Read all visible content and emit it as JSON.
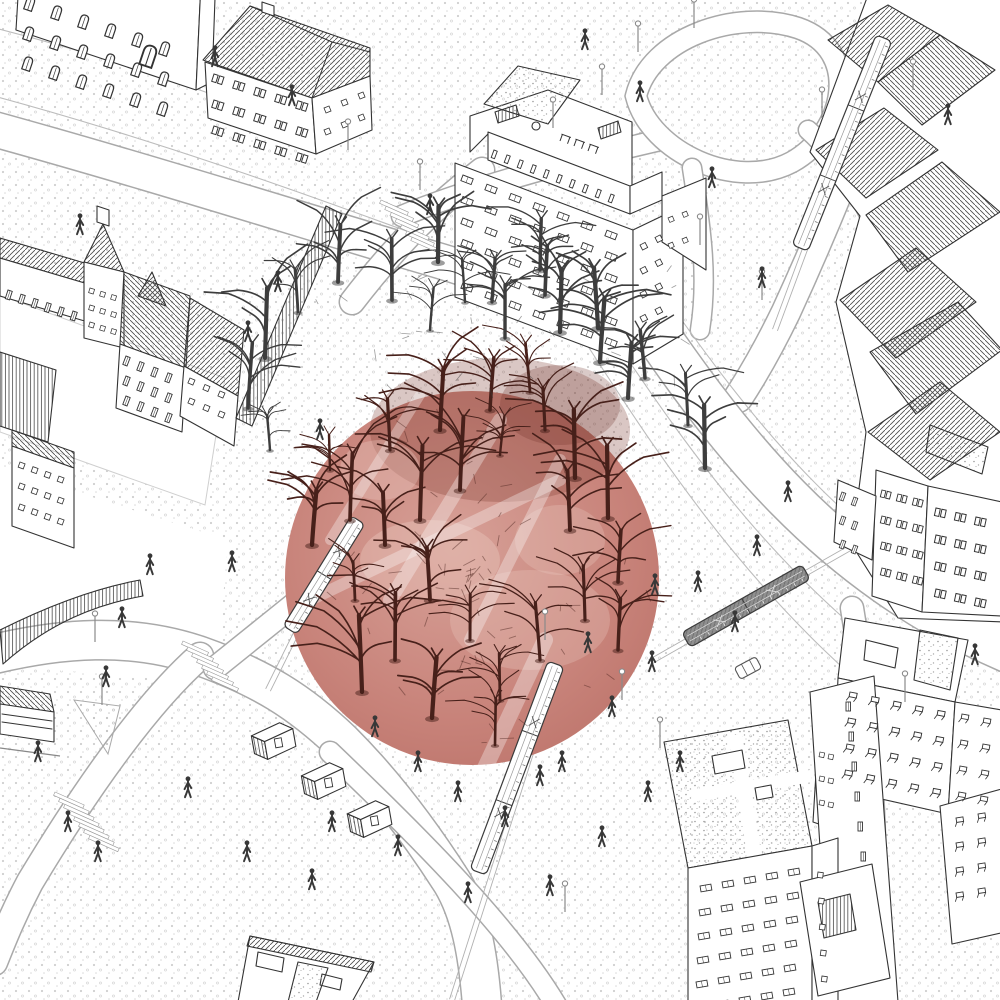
{
  "meta": {
    "title": "Hand-drawn axonometric city illustration with a red circular highlight over a bare-tree park",
    "style": "black ink line drawing, stippled ground texture, single dusty-red photographic circle"
  },
  "colors": {
    "background": "#ffffff",
    "ink": "#333333",
    "road_edge": "#a9a9a9",
    "dots": "#c6c6c6",
    "circle_base": "#c8837a",
    "circle_light": "#ecc9bf",
    "circle_dark": "#7a352c",
    "tree_red": "#47201a",
    "tree_gray": "#3d3d3d",
    "figure": "#383838",
    "lamp": "#8a8a8a"
  },
  "scene": {
    "highlight_circle": {
      "cx": 472,
      "cy": 578,
      "r": 187
    },
    "buildings": [
      {
        "name": "building-arched-facade",
        "label": "historic block with arched windows, top-left"
      },
      {
        "name": "building-hip-roof",
        "label": "hip-roof block, top-left"
      },
      {
        "name": "building-historic-school",
        "label": "historic school with tower, left"
      },
      {
        "name": "building-modernist-tower",
        "label": "modernist slab tower, top-center"
      },
      {
        "name": "building-old-town",
        "label": "dense old-town roofs, right edge"
      },
      {
        "name": "building-flat-slabs",
        "label": "flat apartment slabs, mid-right"
      },
      {
        "name": "building-residential-tower",
        "label": "tall residential tower, bottom-right"
      },
      {
        "name": "building-pavilion",
        "label": "flat pavilion, bottom-center"
      }
    ],
    "window_grids": [
      {
        "g": "w-arch",
        "x": 28,
        "y": -4,
        "ux": 27,
        "uy": 9,
        "vx": -1,
        "vy": 30,
        "cols": 6,
        "rows": 3,
        "rot": 18.5,
        "s": 1.35
      },
      {
        "g": "w-arch",
        "x": 146,
        "y": 44,
        "ux": 0,
        "uy": 0,
        "vx": 0,
        "vy": 0,
        "cols": 1,
        "rows": 1,
        "rot": 18.5,
        "s": 2.1
      },
      {
        "g": "w-pair",
        "x": 214,
        "y": 74,
        "ux": 21,
        "uy": 6.7,
        "vx": 0,
        "vy": 26,
        "cols": 5,
        "rows": 3,
        "rot": 17.5,
        "s": 1.1
      },
      {
        "g": "w-sq",
        "x": 324,
        "y": 108,
        "ux": 17,
        "uy": -7,
        "vx": 0,
        "vy": 22,
        "cols": 3,
        "rows": 2,
        "rot": -22,
        "s": 0.9
      },
      {
        "g": "w-tall",
        "x": 126,
        "y": 356,
        "ux": 14,
        "uy": 5.6,
        "vx": 0,
        "vy": 20,
        "cols": 4,
        "rows": 3,
        "rot": 21,
        "s": 1
      },
      {
        "g": "w-sq",
        "x": 90,
        "y": 288,
        "ux": 11,
        "uy": 3.3,
        "vx": 0,
        "vy": 17,
        "cols": 3,
        "rows": 3,
        "rot": 17,
        "s": 0.8
      },
      {
        "g": "w-sq",
        "x": 20,
        "y": 462,
        "ux": 13,
        "uy": 4.7,
        "vx": 0,
        "vy": 21,
        "cols": 4,
        "rows": 3,
        "rot": 20,
        "s": 0.9
      },
      {
        "g": "w-tall",
        "x": 8,
        "y": 290,
        "ux": 13,
        "uy": 4.2,
        "vx": 0,
        "vy": 0,
        "cols": 6,
        "rows": 1,
        "rot": 18,
        "s": 1
      },
      {
        "g": "w-sq",
        "x": 190,
        "y": 378,
        "ux": 15,
        "uy": 6.5,
        "vx": 0,
        "vy": 20,
        "cols": 3,
        "rows": 2,
        "rot": 23,
        "s": 0.9
      },
      {
        "g": "w-rect",
        "x": 463,
        "y": 175,
        "ux": 24,
        "uy": 9.2,
        "vx": 0,
        "vy": 21.5,
        "cols": 7,
        "rows": 6,
        "rot": 21,
        "s": 1
      },
      {
        "g": "w-sq",
        "x": 640,
        "y": 245,
        "ux": 15,
        "uy": -7.5,
        "vx": 0,
        "vy": 24,
        "cols": 2,
        "rows": 4,
        "rot": -27,
        "s": 0.95
      },
      {
        "g": "w-pane",
        "x": 494,
        "y": 150,
        "ux": 13,
        "uy": 4.9,
        "vx": 0,
        "vy": 0,
        "cols": 10,
        "rows": 1,
        "rot": 20.5,
        "s": 1
      },
      {
        "g": "w-sq",
        "x": 668,
        "y": 218,
        "ux": 14,
        "uy": -5,
        "vx": 0,
        "vy": 26,
        "cols": 2,
        "rows": 2,
        "rot": -23,
        "s": 0.8
      },
      {
        "g": "w-pair",
        "x": 882,
        "y": 490,
        "ux": 16,
        "uy": 4,
        "vx": 0,
        "vy": 26,
        "cols": 3,
        "rows": 4,
        "rot": 14,
        "s": 1
      },
      {
        "g": "w-pair",
        "x": 936,
        "y": 508,
        "ux": 20,
        "uy": 4.5,
        "vx": 0,
        "vy": 27,
        "cols": 3,
        "rows": 4,
        "rot": 12,
        "s": 1.1
      },
      {
        "g": "w-tall",
        "x": 842,
        "y": 492,
        "ux": 12,
        "uy": 5,
        "vx": 0,
        "vy": 24,
        "cols": 2,
        "rows": 3,
        "rot": 20,
        "s": 0.9
      },
      {
        "g": "w-balc",
        "x": 850,
        "y": 692,
        "ux": 22,
        "uy": 4.6,
        "vx": -1.5,
        "vy": 26,
        "cols": 5,
        "rows": 4,
        "rot": 11,
        "s": 1.05
      },
      {
        "g": "w-balc",
        "x": 962,
        "y": 714,
        "ux": 22,
        "uy": 4,
        "vx": -1,
        "vy": 26,
        "cols": 2,
        "rows": 4,
        "rot": 10,
        "s": 1
      },
      {
        "g": "w-rect",
        "x": 700,
        "y": 886,
        "ux": 22,
        "uy": -4,
        "vx": -1,
        "vy": 24,
        "cols": 5,
        "rows": 6,
        "rot": -10,
        "s": 1
      },
      {
        "g": "w-sq",
        "x": 818,
        "y": 872,
        "ux": 0,
        "uy": 0,
        "vx": 1,
        "vy": 26,
        "cols": 1,
        "rows": 5,
        "rot": 8,
        "s": 0.9
      },
      {
        "g": "w-tall",
        "x": 846,
        "y": 702,
        "ux": 0,
        "uy": 0,
        "vx": 3,
        "vy": 30,
        "cols": 1,
        "rows": 6,
        "rot": 0,
        "s": 1
      },
      {
        "g": "w-balc",
        "x": 956,
        "y": 818,
        "ux": 22,
        "uy": -4,
        "vx": 0,
        "vy": 25,
        "cols": 2,
        "rows": 4,
        "rot": -9,
        "s": 1
      },
      {
        "g": "w-sq",
        "x": 820,
        "y": 752,
        "ux": 9,
        "uy": 2,
        "vx": 0,
        "vy": 24,
        "cols": 2,
        "rows": 3,
        "rot": 12,
        "s": 0.8
      }
    ],
    "trams": [
      {
        "x1": 884,
        "y1": 38,
        "x2": 800,
        "y2": 248,
        "w": 17,
        "tone": "light",
        "segs": 3,
        "name": "tram-northeast"
      },
      {
        "x1": 806,
        "y1": 572,
        "x2": 686,
        "y2": 640,
        "w": 17,
        "tone": "dark",
        "segs": 2,
        "name": "tram-east"
      },
      {
        "x1": 556,
        "y1": 664,
        "x2": 478,
        "y2": 872,
        "w": 17,
        "tone": "light",
        "segs": 3,
        "name": "tram-south"
      },
      {
        "x1": 358,
        "y1": 520,
        "x2": 290,
        "y2": 630,
        "w": 16,
        "tone": "light",
        "segs": 2,
        "name": "tram-park-west"
      }
    ],
    "tram_rails": [
      [
        893,
        12,
        775,
        330
      ],
      [
        850,
        548,
        650,
        662
      ],
      [
        575,
        615,
        452,
        1000
      ],
      [
        372,
        480,
        268,
        690
      ]
    ],
    "kiosks": [
      {
        "x": 250,
        "y": 728,
        "rot": -10
      },
      {
        "x": 300,
        "y": 768,
        "rot": -10
      },
      {
        "x": 346,
        "y": 806,
        "rot": -10
      }
    ],
    "car": {
      "x": 748,
      "y": 668,
      "rot": -28
    },
    "crosswalks": [
      {
        "x": 381,
        "y": 200,
        "rot": 24,
        "n": 7,
        "sx": 5.2,
        "sy": 6.2,
        "len": 30
      },
      {
        "x": 183,
        "y": 641,
        "rot": 24,
        "n": 7,
        "sx": 5.0,
        "sy": 6.0,
        "len": 28
      },
      {
        "x": 55,
        "y": 792,
        "rot": 24,
        "n": 8,
        "sx": 5.0,
        "sy": 6.2,
        "len": 32
      }
    ],
    "park_paths": [
      [
        420,
        395,
        330,
        540,
        10
      ],
      [
        500,
        420,
        390,
        600,
        14
      ],
      [
        560,
        460,
        470,
        640,
        12
      ],
      [
        310,
        600,
        560,
        480,
        12
      ],
      [
        545,
        640,
        470,
        800,
        16
      ]
    ],
    "trees": {
      "inside": [
        [
          355,
          600
        ],
        [
          395,
          660
        ],
        [
          430,
          600
        ],
        [
          470,
          640
        ],
        [
          500,
          700
        ],
        [
          540,
          660
        ],
        [
          585,
          620
        ],
        [
          618,
          582
        ],
        [
          608,
          518
        ],
        [
          575,
          478
        ],
        [
          545,
          430
        ],
        [
          500,
          455
        ],
        [
          460,
          490
        ],
        [
          420,
          520
        ],
        [
          385,
          545
        ],
        [
          350,
          520
        ],
        [
          330,
          470
        ],
        [
          390,
          450
        ],
        [
          440,
          430
        ],
        [
          490,
          410
        ],
        [
          530,
          392
        ],
        [
          570,
          530
        ],
        [
          618,
          650
        ],
        [
          495,
          745
        ],
        [
          432,
          718
        ],
        [
          312,
          545
        ],
        [
          362,
          692
        ]
      ],
      "outside": [
        [
          265,
          358
        ],
        [
          298,
          312
        ],
        [
          338,
          282
        ],
        [
          392,
          300
        ],
        [
          438,
          262
        ],
        [
          492,
          302
        ],
        [
          545,
          295
        ],
        [
          598,
          328
        ],
        [
          645,
          378
        ],
        [
          688,
          425
        ],
        [
          248,
          408
        ],
        [
          705,
          468
        ],
        [
          430,
          330
        ],
        [
          465,
          302
        ],
        [
          505,
          338
        ],
        [
          560,
          332
        ],
        [
          600,
          362
        ],
        [
          628,
          398
        ],
        [
          270,
          450
        ],
        [
          540,
          270
        ]
      ]
    },
    "people": [
      [
        215,
        57
      ],
      [
        292,
        96
      ],
      [
        80,
        225
      ],
      [
        278,
        282
      ],
      [
        248,
        332
      ],
      [
        320,
        430
      ],
      [
        232,
        562
      ],
      [
        150,
        565
      ],
      [
        122,
        618
      ],
      [
        106,
        677
      ],
      [
        38,
        752
      ],
      [
        68,
        822
      ],
      [
        98,
        852
      ],
      [
        188,
        788
      ],
      [
        247,
        852
      ],
      [
        312,
        880
      ],
      [
        332,
        822
      ],
      [
        398,
        846
      ],
      [
        468,
        893
      ],
      [
        550,
        886
      ],
      [
        602,
        837
      ],
      [
        648,
        792
      ],
      [
        680,
        762
      ],
      [
        562,
        762
      ],
      [
        612,
        707
      ],
      [
        652,
        662
      ],
      [
        588,
        643
      ],
      [
        540,
        776
      ],
      [
        375,
        727
      ],
      [
        418,
        762
      ],
      [
        458,
        792
      ],
      [
        505,
        817
      ],
      [
        585,
        40
      ],
      [
        640,
        92
      ],
      [
        712,
        178
      ],
      [
        762,
        278
      ],
      [
        788,
        492
      ],
      [
        757,
        546
      ],
      [
        698,
        582
      ],
      [
        735,
        622
      ],
      [
        948,
        115
      ],
      [
        975,
        655
      ],
      [
        430,
        205
      ],
      [
        655,
        585
      ]
    ],
    "lamps": [
      [
        638,
        52
      ],
      [
        694,
        28
      ],
      [
        602,
        95
      ],
      [
        553,
        128
      ],
      [
        348,
        150
      ],
      [
        420,
        190
      ],
      [
        822,
        118
      ],
      [
        913,
        90
      ],
      [
        700,
        245
      ],
      [
        762,
        300
      ],
      [
        95,
        642
      ],
      [
        102,
        705
      ],
      [
        545,
        640
      ],
      [
        622,
        700
      ],
      [
        660,
        748
      ],
      [
        565,
        912
      ],
      [
        905,
        702
      ]
    ]
  }
}
